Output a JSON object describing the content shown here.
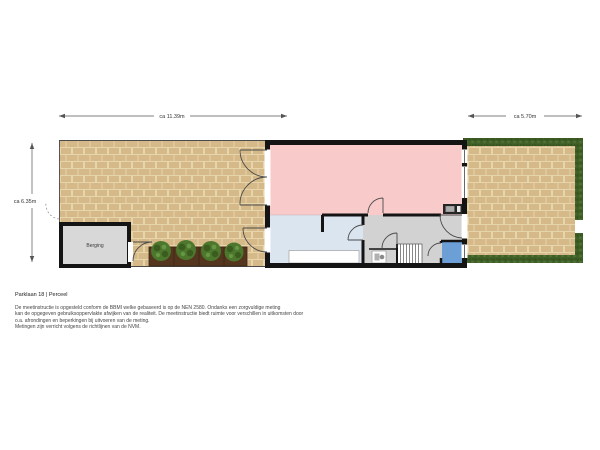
{
  "plan": {
    "dimensions": {
      "width_back_garden": "ca 11.39m",
      "width_front_garden": "ca 5.70m",
      "depth": "ca 6.35m"
    },
    "labels": {
      "shed": "Berging"
    }
  },
  "footer": {
    "title": "Parklaan 18 | Perceel",
    "disclaimer_lines": [
      "De meetinstructie is opgesteld conform de BBMI welke gebaseerd is op de NEN 2580. Ondanks een zorgvuldige meting",
      "kan de opgegeven gebruiksoppervlakte afwijken van de realiteit. De meetinstructie biedt ruimte voor verschillen in uitkomsten door",
      "o.a. afrondingen en beperkingen bij uitvoeren van de meting.",
      "Metingen zijn verricht volgens de richtlijnen van de NVM."
    ]
  },
  "colors": {
    "wall": "#141414",
    "living": "#f8caca",
    "kitchen": "#dbe5f0",
    "hall": "#d2d2d2",
    "shower": "#6b9fd6",
    "shed": "#d8d8d8",
    "brick": "#d6b988",
    "grout": "#e6d4ab",
    "hedge": "#406028",
    "soil": "#54361f",
    "shrub": "#4c772d",
    "dim": "#555555",
    "text": "#333333"
  }
}
